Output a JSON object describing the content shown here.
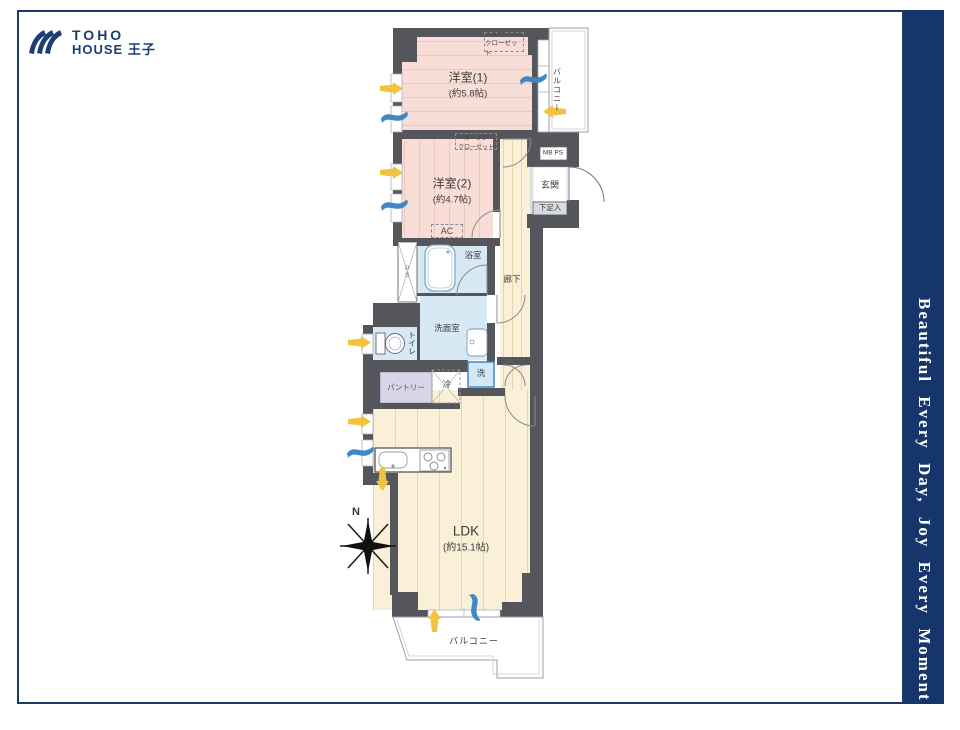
{
  "logo": {
    "title_line1": "TOHO",
    "title_line2": "HOUSE 王子",
    "color": "#1c3e72"
  },
  "side_banner": {
    "text": "Beautiful  Every Day, Joy Every Moment !!",
    "background": "#15356b",
    "text_color": "#ffffff"
  },
  "floorplan": {
    "rooms": {
      "western1": {
        "name": "洋室(1)",
        "size": "(約5.8帖)"
      },
      "western2": {
        "name": "洋室(2)",
        "size": "(約4.7帖)"
      },
      "ldk": {
        "name": "LDK",
        "size": "(約15.1帖)"
      },
      "bath": {
        "name": "浴室"
      },
      "washroom": {
        "name": "洗面室"
      },
      "toilet": {
        "name": "トイレ"
      },
      "corridor": {
        "name": "廊下"
      },
      "entrance": {
        "name": "玄関"
      },
      "pantry": {
        "name": "パントリー"
      }
    },
    "labels": {
      "open_closet_line1": "オープン",
      "open_closet_line2": "クローゼット",
      "balcony": "バルコニー",
      "mb_ps": "MB PS",
      "shoe_box": "下足入",
      "ac": "AC",
      "ps": "PS",
      "fridge": "冷",
      "washer": "洗",
      "north": "N"
    },
    "colors": {
      "wall": "#55565c",
      "western_room_fill": "#f8ded6",
      "wood_floor_fill": "#faf0d8",
      "wet_area_fill": "#d6e9f5",
      "pantry_fill": "#dad4e9",
      "shoe_box_fill": "#d7dbe2",
      "accent_yellow": "#f2c33e",
      "accent_blue": "#3f87c5"
    }
  }
}
